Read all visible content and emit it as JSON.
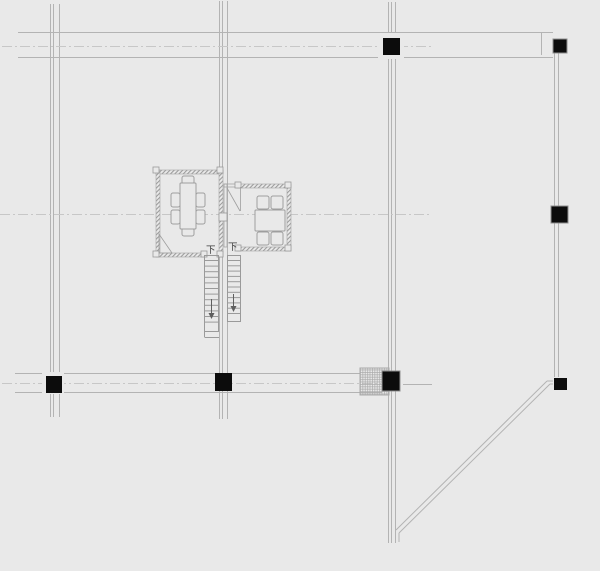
{
  "canvas": {
    "width": 600,
    "height": 571,
    "background": "#e9e9e9"
  },
  "palette": {
    "grid": "#b3b3b3",
    "centerline": "#c7c7c7",
    "wall_edge": "#a4a4a4",
    "furniture": "#9e9e9e",
    "stair": "#9a9a9a",
    "marker": "#9a9a9a",
    "column_fill": "#0c0c0c",
    "column_edge": "#8f8f8f",
    "arrow": "#5f5f5f",
    "text": "#3c3c3c",
    "backing": "#e9e9e9",
    "hatch_edge": "#a9a9a9"
  },
  "labels": {
    "stair_down_left": "下",
    "stair_down_right": "下"
  },
  "elements": [
    {
      "type": "line",
      "name": "grid-axis-v1-line1",
      "x1": 50.5,
      "y1": 4,
      "x2": 50.5,
      "y2": 417,
      "stroke": "grid"
    },
    {
      "type": "line",
      "name": "grid-axis-v1-line2",
      "x1": 53.5,
      "y1": 4,
      "x2": 53.5,
      "y2": 417,
      "stroke": "grid"
    },
    {
      "type": "line",
      "name": "grid-axis-v1-line3",
      "x1": 59.5,
      "y1": 4,
      "x2": 59.5,
      "y2": 417,
      "stroke": "grid"
    },
    {
      "type": "line",
      "name": "grid-axis-v2-line1",
      "x1": 219.5,
      "y1": 1,
      "x2": 219.5,
      "y2": 419,
      "stroke": "grid"
    },
    {
      "type": "line",
      "name": "grid-axis-v2-line2",
      "x1": 222.5,
      "y1": 1,
      "x2": 222.5,
      "y2": 419,
      "stroke": "grid"
    },
    {
      "type": "line",
      "name": "grid-axis-v2-line3",
      "x1": 227.5,
      "y1": 1,
      "x2": 227.5,
      "y2": 419,
      "stroke": "grid"
    },
    {
      "type": "line",
      "name": "grid-axis-v3-line1",
      "x1": 388.5,
      "y1": 2,
      "x2": 388.5,
      "y2": 543,
      "stroke": "grid"
    },
    {
      "type": "line",
      "name": "grid-axis-v3-line2",
      "x1": 391.5,
      "y1": 2,
      "x2": 391.5,
      "y2": 543,
      "stroke": "grid"
    },
    {
      "type": "line",
      "name": "grid-axis-v3-line3",
      "x1": 395.5,
      "y1": 2,
      "x2": 395.5,
      "y2": 543,
      "stroke": "grid"
    },
    {
      "type": "line",
      "name": "grid-axis-v4-line1",
      "x1": 554.5,
      "y1": 53,
      "x2": 554.5,
      "y2": 377,
      "stroke": "grid"
    },
    {
      "type": "line",
      "name": "grid-axis-v4-line2",
      "x1": 558.5,
      "y1": 53,
      "x2": 558.5,
      "y2": 377,
      "stroke": "grid"
    },
    {
      "type": "line",
      "name": "top-beam-upper-line",
      "x1": 18,
      "y1": 32.5,
      "x2": 553,
      "y2": 32.5,
      "stroke": "grid"
    },
    {
      "type": "line",
      "name": "top-beam-lower-line",
      "x1": 18,
      "y1": 57.5,
      "x2": 553,
      "y2": 57.5,
      "stroke": "grid"
    },
    {
      "type": "line",
      "name": "top-beam-end-cap",
      "x1": 541.5,
      "y1": 33,
      "x2": 541.5,
      "y2": 55,
      "stroke": "grid"
    },
    {
      "type": "line",
      "name": "bottom-beam-upper-line",
      "x1": 15,
      "y1": 373.5,
      "x2": 360,
      "y2": 373.5,
      "stroke": "grid"
    },
    {
      "type": "line",
      "name": "bottom-beam-lower-line",
      "x1": 15,
      "y1": 392.5,
      "x2": 382,
      "y2": 392.5,
      "stroke": "grid"
    },
    {
      "type": "line",
      "name": "bottom-beam-stub-right",
      "x1": 403,
      "y1": 384.5,
      "x2": 432,
      "y2": 384.5,
      "stroke": "grid"
    },
    {
      "type": "line",
      "name": "centerline-top-axis",
      "x1": 2,
      "y1": 46.5,
      "x2": 431,
      "y2": 46.5,
      "stroke": "centerline",
      "dash": "10 3 2 3"
    },
    {
      "type": "line",
      "name": "centerline-middle-axis",
      "x1": 0,
      "y1": 214.5,
      "x2": 431,
      "y2": 214.5,
      "stroke": "centerline",
      "dash": "10 3 2 3"
    },
    {
      "type": "line",
      "name": "centerline-bottom-axis",
      "x1": 2,
      "y1": 383.5,
      "x2": 381,
      "y2": 383.5,
      "stroke": "centerline",
      "dash": "10 3 2 3"
    },
    {
      "type": "line",
      "name": "boundary-diagonal-outer",
      "x1": 547,
      "y1": 381,
      "x2": 396,
      "y2": 530,
      "stroke": "grid"
    },
    {
      "type": "line",
      "name": "boundary-diagonal-outer-stub",
      "x1": 547,
      "y1": 381,
      "x2": 553,
      "y2": 381,
      "stroke": "grid"
    },
    {
      "type": "line",
      "name": "boundary-diagonal-inner",
      "x1": 550,
      "y1": 384,
      "x2": 399,
      "y2": 533,
      "stroke": "grid"
    },
    {
      "type": "line",
      "name": "boundary-diagonal-inner-stub",
      "x1": 550,
      "y1": 384,
      "x2": 553,
      "y2": 384,
      "stroke": "grid"
    },
    {
      "type": "line",
      "name": "boundary-diagonal-tail",
      "x1": 399,
      "y1": 533,
      "x2": 399,
      "y2": 542,
      "stroke": "grid"
    },
    {
      "type": "rect",
      "name": "column-backing-top-middle",
      "x": 378,
      "y": 33,
      "w": 26,
      "h": 26,
      "fill": "backing",
      "stroke": "none"
    },
    {
      "type": "rect",
      "name": "column-backing-bottom-left",
      "x": 42,
      "y": 372,
      "w": 22,
      "h": 22,
      "fill": "backing",
      "stroke": "none"
    },
    {
      "type": "rect",
      "name": "hatched-pier-box",
      "x": 360,
      "y": 368,
      "w": 29,
      "h": 27,
      "fill": "url(#crosshatch)",
      "stroke": "hatch_edge"
    },
    {
      "type": "rect",
      "name": "left-room-wall-top",
      "x": 156,
      "y": 170,
      "w": 67,
      "h": 4,
      "fill": "url(#wallhatch)",
      "stroke": "wall_edge",
      "sw": 0.6
    },
    {
      "type": "rect",
      "name": "left-room-wall-left",
      "x": 156,
      "y": 170,
      "w": 4,
      "h": 87,
      "fill": "url(#wallhatch)",
      "stroke": "wall_edge",
      "sw": 0.6
    },
    {
      "type": "rect",
      "name": "left-room-wall-right",
      "x": 219,
      "y": 170,
      "w": 4,
      "h": 87,
      "fill": "url(#wallhatch)",
      "stroke": "wall_edge",
      "sw": 0.6
    },
    {
      "type": "rect",
      "name": "left-room-wall-bottom",
      "x": 156,
      "y": 253,
      "w": 48,
      "h": 4,
      "fill": "url(#wallhatch)",
      "stroke": "wall_edge",
      "sw": 0.6
    },
    {
      "type": "rect",
      "name": "right-room-wall-top",
      "x": 237,
      "y": 184,
      "w": 54,
      "h": 4,
      "fill": "url(#wallhatch)",
      "stroke": "wall_edge",
      "sw": 0.6
    },
    {
      "type": "rect",
      "name": "right-room-wall-right",
      "x": 287,
      "y": 184,
      "w": 4,
      "h": 67,
      "fill": "url(#wallhatch)",
      "stroke": "wall_edge",
      "sw": 0.6
    },
    {
      "type": "rect",
      "name": "right-room-wall-bottom",
      "x": 237,
      "y": 247,
      "w": 54,
      "h": 4,
      "fill": "url(#wallhatch)",
      "stroke": "wall_edge",
      "sw": 0.6
    },
    {
      "type": "rect",
      "name": "right-room-wall-left",
      "x": 224,
      "y": 184,
      "w": 3,
      "h": 63,
      "fill": "none",
      "stroke": "wall_edge",
      "sw": 0.8
    },
    {
      "type": "rect",
      "name": "right-room-door-header",
      "x": 224,
      "y": 184,
      "w": 13,
      "h": 3,
      "fill": "none",
      "stroke": "wall_edge",
      "sw": 0.8
    },
    {
      "type": "rect",
      "name": "wall-corner-marker",
      "x": 153,
      "y": 167,
      "w": 6,
      "h": 6,
      "fill": "backing",
      "stroke": "marker",
      "sw": 0.8
    },
    {
      "type": "rect",
      "name": "wall-corner-marker",
      "x": 217,
      "y": 167,
      "w": 6,
      "h": 6,
      "fill": "backing",
      "stroke": "marker",
      "sw": 0.8
    },
    {
      "type": "rect",
      "name": "wall-corner-marker",
      "x": 153,
      "y": 251,
      "w": 6,
      "h": 6,
      "fill": "backing",
      "stroke": "marker",
      "sw": 0.8
    },
    {
      "type": "rect",
      "name": "wall-corner-marker",
      "x": 217,
      "y": 251,
      "w": 6,
      "h": 6,
      "fill": "backing",
      "stroke": "marker",
      "sw": 0.8
    },
    {
      "type": "rect",
      "name": "wall-jamb-marker",
      "x": 201,
      "y": 251,
      "w": 6,
      "h": 6,
      "fill": "backing",
      "stroke": "marker",
      "sw": 0.8
    },
    {
      "type": "rect",
      "name": "wall-jamb-marker",
      "x": 235,
      "y": 182,
      "w": 6,
      "h": 6,
      "fill": "backing",
      "stroke": "marker",
      "sw": 0.8
    },
    {
      "type": "rect",
      "name": "wall-corner-marker",
      "x": 285,
      "y": 182,
      "w": 6,
      "h": 6,
      "fill": "backing",
      "stroke": "marker",
      "sw": 0.8
    },
    {
      "type": "rect",
      "name": "wall-corner-marker",
      "x": 285,
      "y": 245,
      "w": 6,
      "h": 6,
      "fill": "backing",
      "stroke": "marker",
      "sw": 0.8
    },
    {
      "type": "rect",
      "name": "wall-jamb-marker",
      "x": 235,
      "y": 245,
      "w": 6,
      "h": 6,
      "fill": "backing",
      "stroke": "marker",
      "sw": 0.8
    },
    {
      "type": "rect",
      "name": "room-junction-box",
      "x": 219,
      "y": 213,
      "w": 8,
      "h": 8,
      "fill": "backing",
      "stroke": "marker",
      "sw": 0.8
    },
    {
      "type": "rect",
      "name": "left-room-chair-top",
      "x": 182,
      "y": 176,
      "w": 12,
      "h": 8,
      "rx": 2,
      "fill": "backing",
      "stroke": "furniture"
    },
    {
      "type": "rect",
      "name": "left-room-chair-bottom",
      "x": 182,
      "y": 228,
      "w": 12,
      "h": 8,
      "rx": 2,
      "fill": "backing",
      "stroke": "furniture"
    },
    {
      "type": "rect",
      "name": "left-room-chair-left1",
      "x": 171,
      "y": 193,
      "w": 9,
      "h": 14,
      "rx": 2,
      "fill": "backing",
      "stroke": "furniture"
    },
    {
      "type": "rect",
      "name": "left-room-chair-left2",
      "x": 171,
      "y": 210,
      "w": 9,
      "h": 14,
      "rx": 2,
      "fill": "backing",
      "stroke": "furniture"
    },
    {
      "type": "rect",
      "name": "left-room-chair-right1",
      "x": 196,
      "y": 193,
      "w": 9,
      "h": 14,
      "rx": 2,
      "fill": "backing",
      "stroke": "furniture"
    },
    {
      "type": "rect",
      "name": "left-room-chair-right2",
      "x": 196,
      "y": 210,
      "w": 9,
      "h": 14,
      "rx": 2,
      "fill": "backing",
      "stroke": "furniture"
    },
    {
      "type": "rect",
      "name": "left-room-table",
      "x": 180,
      "y": 183,
      "w": 16,
      "h": 46,
      "rx": 1,
      "fill": "backing",
      "stroke": "furniture"
    },
    {
      "type": "rect",
      "name": "right-room-chair-top1",
      "x": 257,
      "y": 196,
      "w": 12,
      "h": 13,
      "rx": 2,
      "fill": "backing",
      "stroke": "furniture"
    },
    {
      "type": "rect",
      "name": "right-room-chair-top2",
      "x": 271,
      "y": 196,
      "w": 12,
      "h": 13,
      "rx": 2,
      "fill": "backing",
      "stroke": "furniture"
    },
    {
      "type": "rect",
      "name": "right-room-chair-bottom1",
      "x": 257,
      "y": 232,
      "w": 12,
      "h": 13,
      "rx": 2,
      "fill": "backing",
      "stroke": "furniture"
    },
    {
      "type": "rect",
      "name": "right-room-chair-bottom2",
      "x": 271,
      "y": 232,
      "w": 12,
      "h": 13,
      "rx": 2,
      "fill": "backing",
      "stroke": "furniture"
    },
    {
      "type": "rect",
      "name": "right-room-table",
      "x": 255,
      "y": 210,
      "w": 30,
      "h": 21,
      "rx": 1,
      "fill": "backing",
      "stroke": "furniture"
    },
    {
      "type": "poly",
      "name": "left-room-door-swing",
      "points": [
        [
          159,
          234
        ],
        [
          159,
          253
        ],
        [
          172,
          253
        ]
      ],
      "closed": true,
      "fill": "none",
      "stroke": "furniture",
      "sw": 0.8
    },
    {
      "type": "line",
      "name": "right-room-door-leaf",
      "x1": 240.5,
      "y1": 187,
      "x2": 240.5,
      "y2": 211,
      "stroke": "furniture",
      "sw": 0.8
    },
    {
      "type": "line",
      "name": "right-room-door-swing",
      "x1": 227,
      "y1": 188,
      "x2": 240,
      "y2": 211,
      "stroke": "furniture",
      "sw": 0.8
    },
    {
      "type": "line",
      "name": "stair-left-rail-outer",
      "x1": 204.5,
      "y1": 255,
      "x2": 204.5,
      "y2": 337,
      "stroke": "stair"
    },
    {
      "type": "line",
      "name": "stair-left-rail-inner",
      "x1": 218.5,
      "y1": 255,
      "x2": 218.5,
      "y2": 331,
      "stroke": "stair"
    },
    {
      "type": "line",
      "name": "stair-left-top-edge",
      "x1": 204,
      "y1": 255.5,
      "x2": 219,
      "y2": 255.5,
      "stroke": "stair"
    },
    {
      "type": "line",
      "name": "stair-left-bottom-edge",
      "x1": 204,
      "y1": 331.5,
      "x2": 219,
      "y2": 331.5,
      "stroke": "stair"
    },
    {
      "type": "line",
      "name": "stair-left-landing-edge",
      "x1": 204.5,
      "y1": 337.5,
      "x2": 219,
      "y2": 337.5,
      "stroke": "stair"
    },
    {
      "type": "ladder",
      "name": "stair-left-treads",
      "x1": 205,
      "x2": 218,
      "from": 260.5,
      "to": 327,
      "step": 5.6,
      "stroke": "stair"
    },
    {
      "type": "line",
      "name": "stair-right-rail-inner",
      "x1": 227.5,
      "y1": 255,
      "x2": 227.5,
      "y2": 322,
      "stroke": "stair"
    },
    {
      "type": "line",
      "name": "stair-right-rail-outer",
      "x1": 240.5,
      "y1": 255,
      "x2": 240.5,
      "y2": 322,
      "stroke": "stair"
    },
    {
      "type": "line",
      "name": "stair-right-top-edge",
      "x1": 227,
      "y1": 255.5,
      "x2": 241,
      "y2": 255.5,
      "stroke": "stair"
    },
    {
      "type": "line",
      "name": "stair-right-bottom-edge",
      "x1": 227,
      "y1": 321.5,
      "x2": 241,
      "y2": 321.5,
      "stroke": "stair"
    },
    {
      "type": "ladder",
      "name": "stair-right-treads",
      "x1": 228,
      "x2": 240,
      "from": 260.5,
      "to": 317,
      "step": 5.3,
      "stroke": "stair"
    },
    {
      "type": "line",
      "name": "stair-left-direction-arrow-stem",
      "x1": 211.5,
      "y1": 299,
      "x2": 211.5,
      "y2": 313,
      "stroke": "arrow"
    },
    {
      "type": "poly",
      "name": "stair-left-direction-arrow-head",
      "points": [
        [
          208.5,
          313
        ],
        [
          214.5,
          313
        ],
        [
          211.5,
          319
        ]
      ],
      "closed": true,
      "fill": "arrow",
      "stroke": "none"
    },
    {
      "type": "line",
      "name": "stair-right-direction-arrow-stem",
      "x1": 233.5,
      "y1": 294,
      "x2": 233.5,
      "y2": 306,
      "stroke": "arrow"
    },
    {
      "type": "poly",
      "name": "stair-right-direction-arrow-head",
      "points": [
        [
          230.5,
          306
        ],
        [
          236.5,
          306
        ],
        [
          233.5,
          312
        ]
      ],
      "closed": true,
      "fill": "arrow",
      "stroke": "none"
    },
    {
      "type": "rect",
      "name": "column-top-middle",
      "x": 383,
      "y": 38,
      "w": 17,
      "h": 17,
      "fill": "column_fill",
      "stroke": "none"
    },
    {
      "type": "rect",
      "name": "column-top-right",
      "x": 553,
      "y": 39,
      "w": 14,
      "h": 14,
      "fill": "column_fill",
      "stroke": "column_edge"
    },
    {
      "type": "rect",
      "name": "column-right-middle",
      "x": 551,
      "y": 206,
      "w": 17,
      "h": 17,
      "fill": "column_fill",
      "stroke": "column_edge"
    },
    {
      "type": "rect",
      "name": "column-bottom-left",
      "x": 46,
      "y": 376,
      "w": 16,
      "h": 17,
      "fill": "column_fill",
      "stroke": "none"
    },
    {
      "type": "rect",
      "name": "column-bottom-middle-left",
      "x": 215,
      "y": 373,
      "w": 17,
      "h": 18,
      "fill": "column_fill",
      "stroke": "none"
    },
    {
      "type": "rect",
      "name": "column-bottom-middle-right",
      "x": 382,
      "y": 371,
      "w": 18,
      "h": 20,
      "fill": "column_fill",
      "stroke": "column_edge"
    },
    {
      "type": "rect",
      "name": "column-bottom-right",
      "x": 554,
      "y": 378,
      "w": 13,
      "h": 12,
      "fill": "column_fill",
      "stroke": "none"
    },
    {
      "type": "text",
      "name": "stair-down-label-left",
      "bind": "labels.stair_down_left",
      "x": 206,
      "y": 253,
      "size": 9.5,
      "fill": "text"
    },
    {
      "type": "text",
      "name": "stair-down-label-right",
      "bind": "labels.stair_down_right",
      "x": 228,
      "y": 250,
      "size": 9.5,
      "fill": "text"
    }
  ]
}
